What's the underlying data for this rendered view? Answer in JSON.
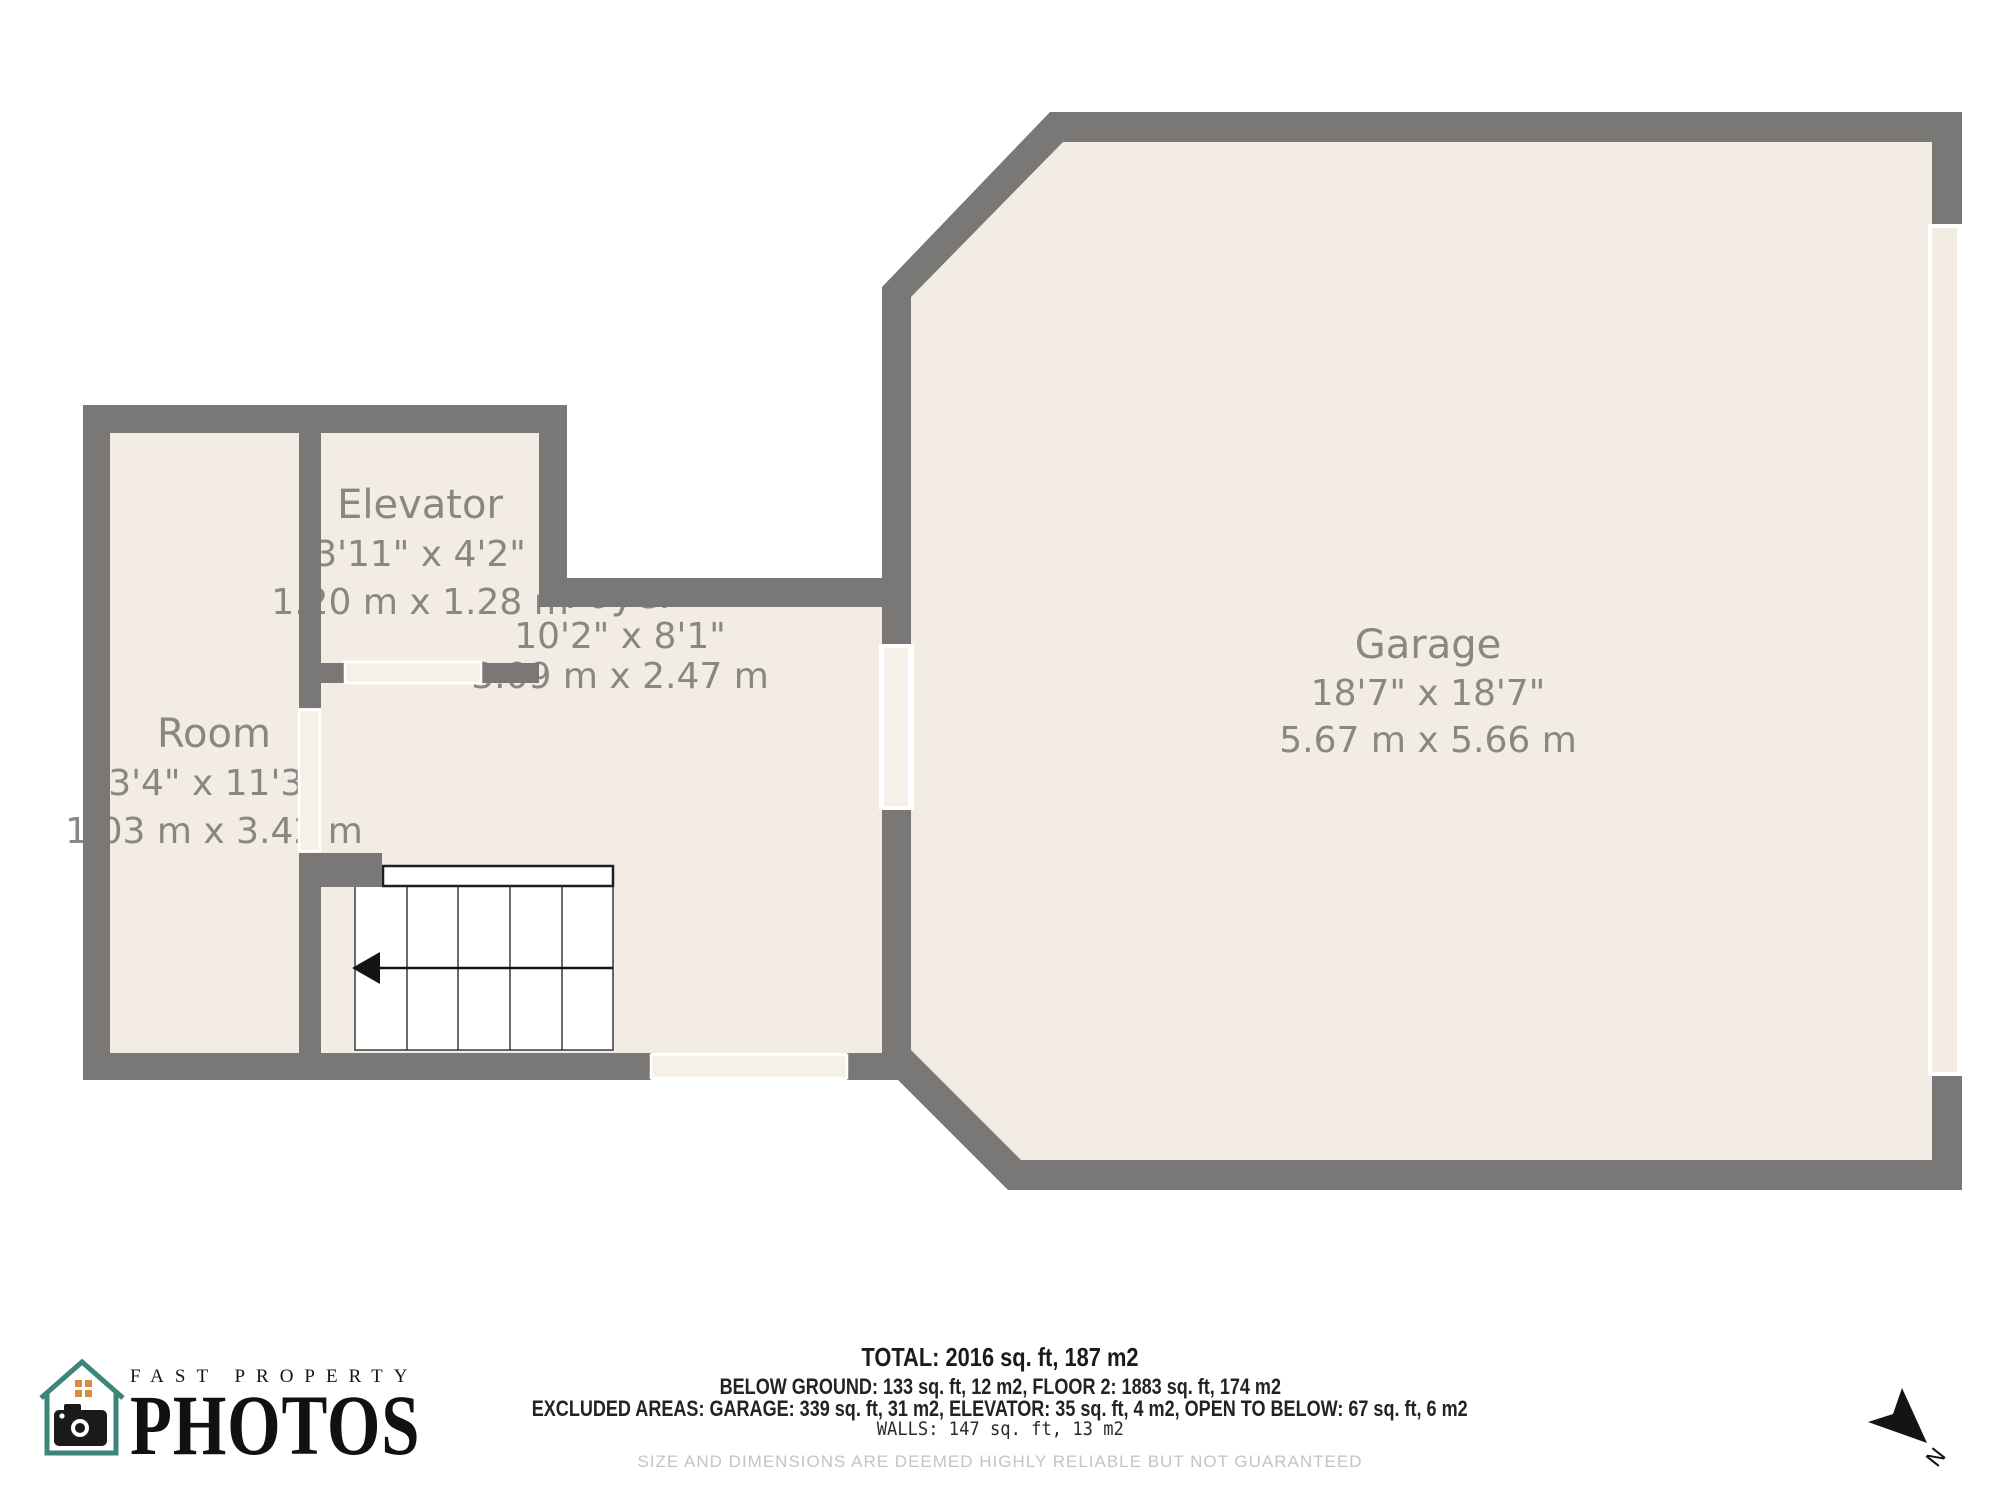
{
  "plan": {
    "wall_color": "#7a7876",
    "floor_color": "#f2ece4",
    "door_color": "#f6f0e9",
    "label_color": "#8a8680",
    "stair_color": "#ffffff",
    "rooms": [
      {
        "name": "Elevator",
        "size_imperial": "3'11\" x 4'2\"",
        "size_metric": "1.20 m x 1.28 m"
      },
      {
        "name": "Room",
        "size_imperial": "3'4\" x 11'3\"",
        "size_metric": "1.03 m x 3.42 m"
      },
      {
        "name": "Foyer",
        "size_imperial": "10'2\" x 8'1\"",
        "size_metric": "3.09 m x 2.47 m"
      },
      {
        "name": "Garage",
        "size_imperial": "18'7\" x 18'7\"",
        "size_metric": "5.67 m x 5.66 m"
      }
    ],
    "compass_label": "N"
  },
  "summary": {
    "total": "TOTAL: 2016 sq. ft, 187 m2",
    "floors": "BELOW GROUND: 133 sq. ft, 12 m2, FLOOR 2: 1883 sq. ft, 174 m2",
    "excluded": "EXCLUDED AREAS: GARAGE: 339 sq. ft, 31 m2, ELEVATOR: 35 sq. ft, 4 m2, OPEN TO BELOW: 67 sq. ft, 6 m2",
    "walls": "WALLS: 147 sq. ft, 13 m2",
    "disclaimer": "SIZE AND DIMENSIONS ARE DEEMED HIGHLY RELIABLE BUT NOT GUARANTEED"
  },
  "logo": {
    "brand_top": "FAST PROPERTY",
    "brand_bottom": "PHOTOS",
    "house_color": "#3d8578",
    "window_color": "#d98c3f"
  }
}
